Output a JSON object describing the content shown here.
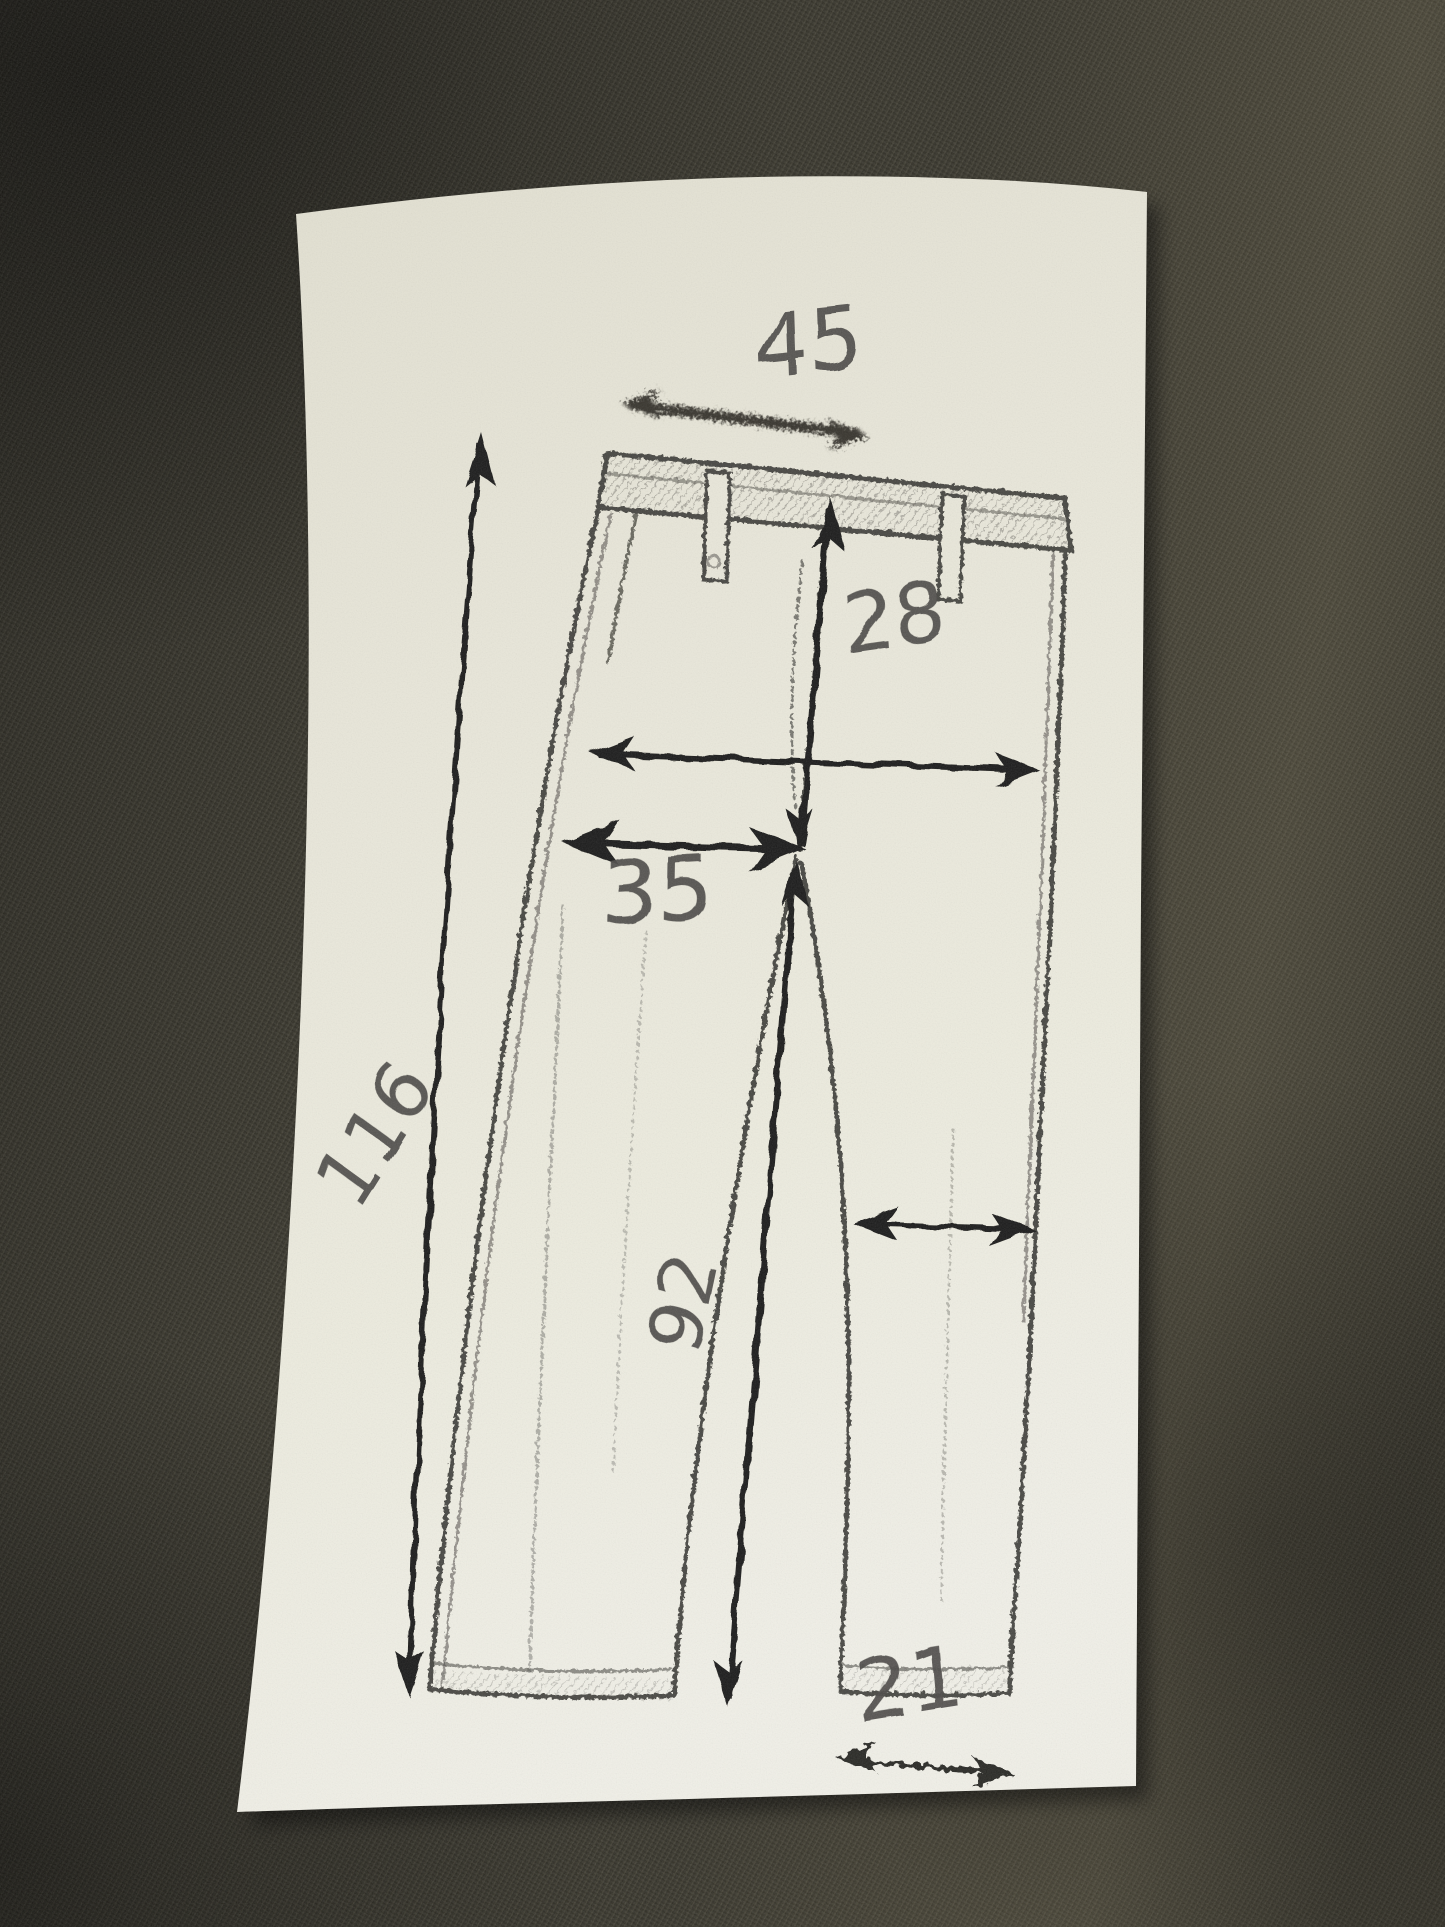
{
  "measurements": {
    "waist_width": "45",
    "front_rise": "28",
    "thigh_width": "35",
    "outseam_length": "116",
    "inseam_length": "92",
    "hem_width": "21"
  },
  "arrows": [
    {
      "name": "waist-width-arrow",
      "label": "45",
      "style": "smudged charcoal double-headed horizontal arrow above waistband"
    },
    {
      "name": "hip-width-arrow",
      "label": "",
      "style": "ink double-headed horizontal arrow across hips"
    },
    {
      "name": "front-rise-arrow",
      "label": "28",
      "style": "ink double-headed vertical arrow from waistband to crotch"
    },
    {
      "name": "thigh-width-arrow",
      "label": "35",
      "style": "ink double-headed horizontal arrow from side seam to crotch"
    },
    {
      "name": "outseam-arrow",
      "label": "116",
      "style": "ink double-headed long vertical arrow left of trousers"
    },
    {
      "name": "inseam-arrow",
      "label": "92",
      "style": "ink vertical arrow from crotch to hem"
    },
    {
      "name": "knee-width-arrow",
      "label": "",
      "style": "ink double-headed horizontal arrow across right leg"
    },
    {
      "name": "hem-width-arrow",
      "label": "21",
      "style": "ink double-headed horizontal arrow under right hem"
    }
  ],
  "colors": {
    "fabric_background": "#37352b",
    "paper": "#e9e7da",
    "printed_sketch": "#33322d",
    "ink_arrows": "#1f1e1b",
    "handwritten_numbers": "#4e4c49"
  }
}
